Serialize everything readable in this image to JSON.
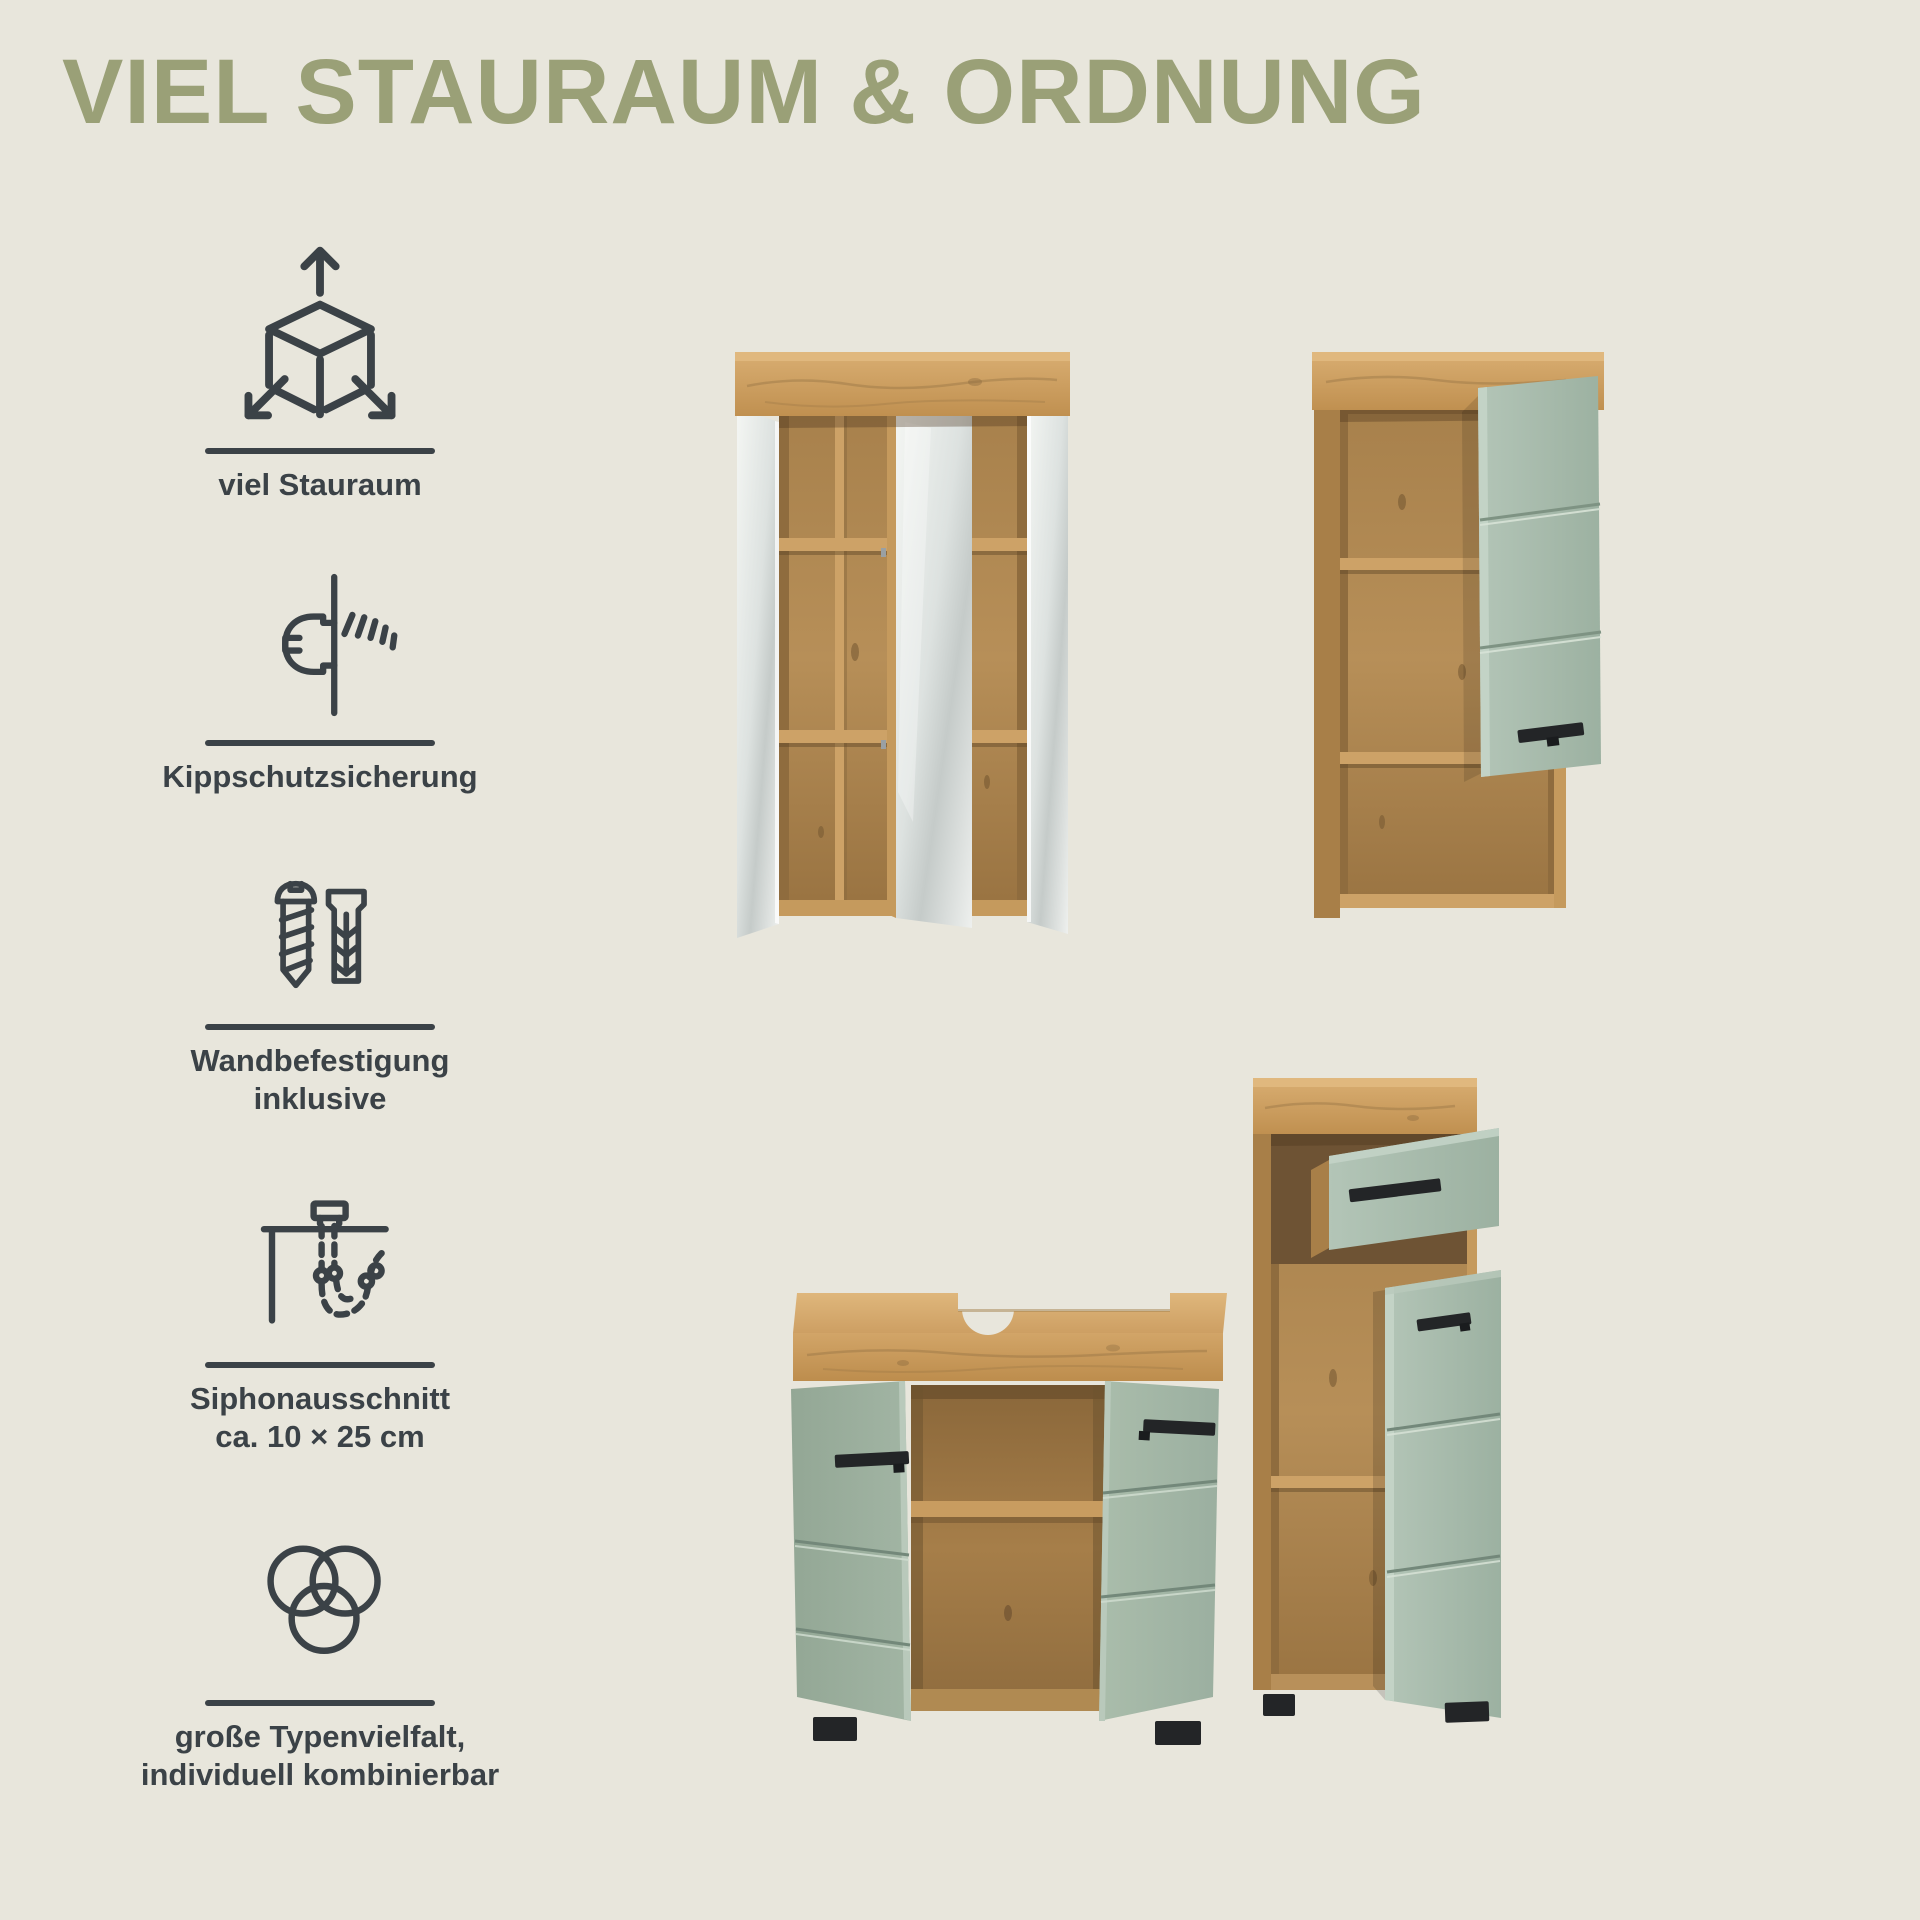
{
  "page": {
    "title": "VIEL STAURAUM & ORDNUNG",
    "background_color": "#e8e6dc",
    "title_color": "#9aa077",
    "text_color": "#3b4247"
  },
  "features": [
    {
      "icon": "cube-expand-arrows-icon",
      "label_lines": [
        "viel Stauraum"
      ]
    },
    {
      "icon": "tip-over-protection-icon",
      "label_lines": [
        "Kippschutzsicherung"
      ]
    },
    {
      "icon": "screw-dowel-icon",
      "label_lines": [
        "Wandbefestigung",
        "inklusive"
      ]
    },
    {
      "icon": "siphon-cutout-icon",
      "label_lines": [
        "Siphonausschnitt",
        "ca. 10 × 25 cm"
      ]
    },
    {
      "icon": "venn-circles-icon",
      "label_lines": [
        "große Typenvielfalt,",
        "individuell kombinierbar"
      ]
    }
  ],
  "products": [
    {
      "name": "mirror-cabinet"
    },
    {
      "name": "wall-cabinet"
    },
    {
      "name": "washbasin-cabinet"
    },
    {
      "name": "side-cabinet"
    }
  ],
  "colors": {
    "oak": "#c89b5e",
    "oak_dark": "#9c7845",
    "sage_green": "#a6bbac",
    "mirror": "#d9dddb",
    "handles_feet": "#232527"
  }
}
